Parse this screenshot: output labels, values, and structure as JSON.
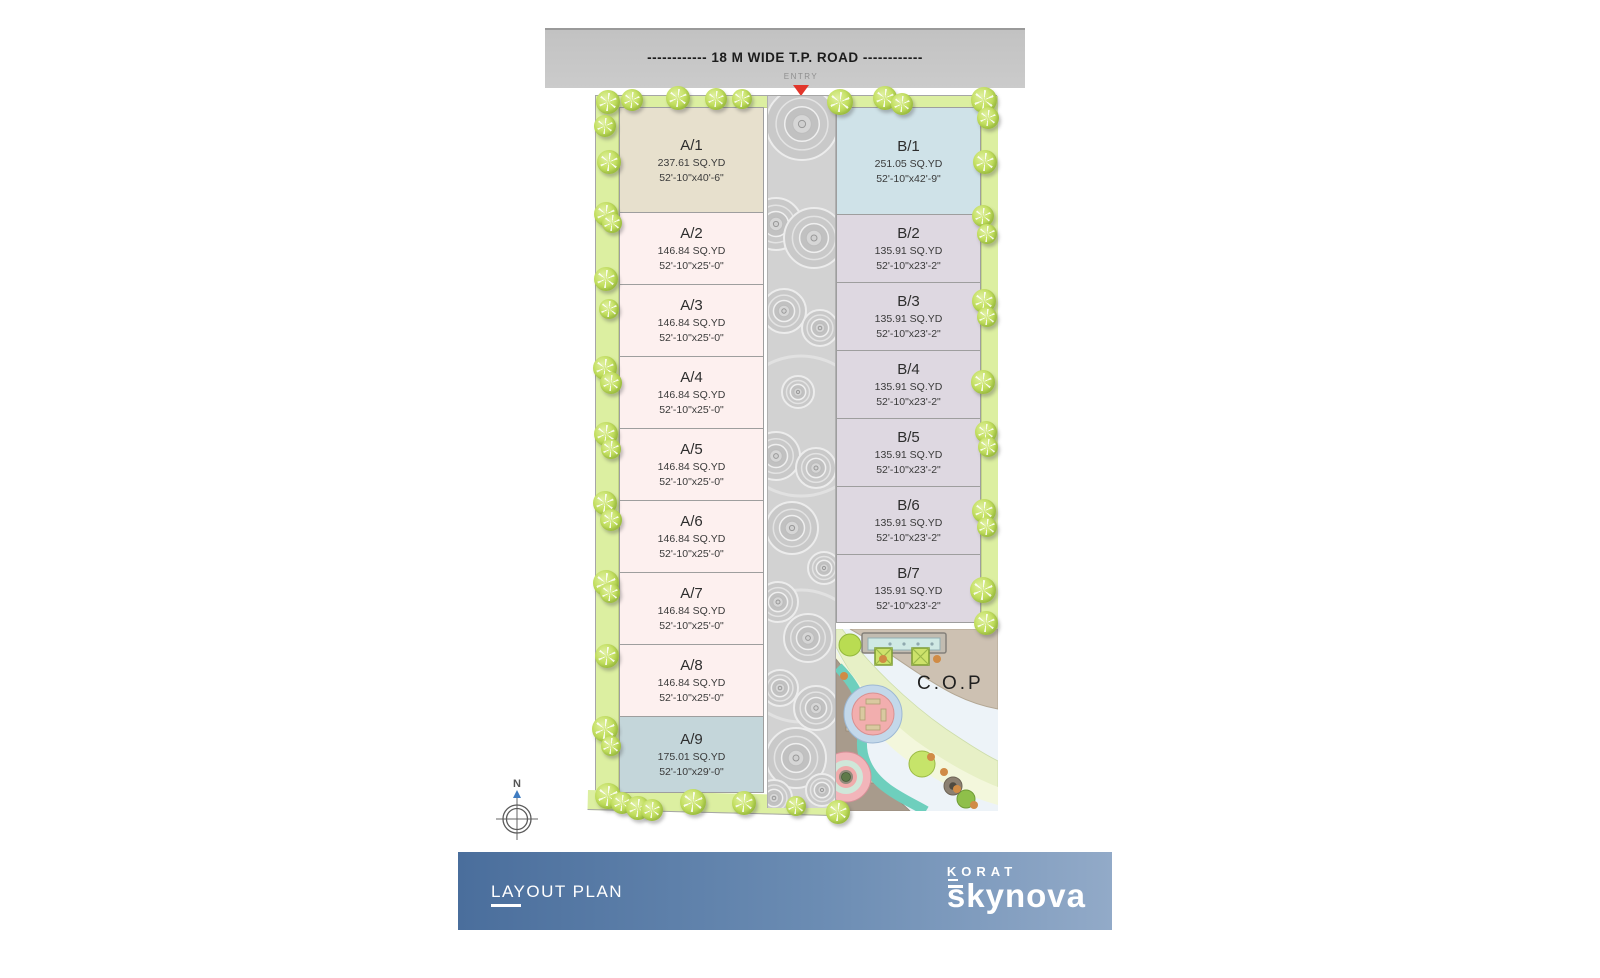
{
  "road_bar": {
    "label": "------------ 18 M WIDE T.P. ROAD ------------"
  },
  "entry": {
    "label": "ENTRY",
    "arrow_color": "#e2362b"
  },
  "plots_a": [
    {
      "label": "A/1",
      "area": "237.61 SQ.YD",
      "size": "52'-10\"x40'-6\"",
      "color": "#e7e0cd",
      "h": 106
    },
    {
      "label": "A/2",
      "area": "146.84 SQ.YD",
      "size": "52'-10\"x25'-0\"",
      "color": "#fdf0ef",
      "h": 73
    },
    {
      "label": "A/3",
      "area": "146.84 SQ.YD",
      "size": "52'-10\"x25'-0\"",
      "color": "#fdf0ef",
      "h": 73
    },
    {
      "label": "A/4",
      "area": "146.84 SQ.YD",
      "size": "52'-10\"x25'-0\"",
      "color": "#fdf0ef",
      "h": 73
    },
    {
      "label": "A/5",
      "area": "146.84 SQ.YD",
      "size": "52'-10\"x25'-0\"",
      "color": "#fdf0ef",
      "h": 73
    },
    {
      "label": "A/6",
      "area": "146.84 SQ.YD",
      "size": "52'-10\"x25'-0\"",
      "color": "#fdf0ef",
      "h": 73
    },
    {
      "label": "A/7",
      "area": "146.84 SQ.YD",
      "size": "52'-10\"x25'-0\"",
      "color": "#fdf0ef",
      "h": 73
    },
    {
      "label": "A/8",
      "area": "146.84 SQ.YD",
      "size": "52'-10\"x25'-0\"",
      "color": "#fdf0ef",
      "h": 73
    },
    {
      "label": "A/9",
      "area": "175.01 SQ.YD",
      "size": "52'-10\"x29'-0\"",
      "color": "#c4d6da",
      "h": 77
    }
  ],
  "plots_b": [
    {
      "label": "B/1",
      "area": "251.05 SQ.YD",
      "size": "52'-10\"x42'-9\"",
      "color": "#cfe2e8",
      "h": 108
    },
    {
      "label": "B/2",
      "area": "135.91 SQ.YD",
      "size": "52'-10\"x23'-2\"",
      "color": "#ded8e1",
      "h": 69
    },
    {
      "label": "B/3",
      "area": "135.91 SQ.YD",
      "size": "52'-10\"x23'-2\"",
      "color": "#ded8e1",
      "h": 69
    },
    {
      "label": "B/4",
      "area": "135.91 SQ.YD",
      "size": "52'-10\"x23'-2\"",
      "color": "#ded8e1",
      "h": 69
    },
    {
      "label": "B/5",
      "area": "135.91 SQ.YD",
      "size": "52'-10\"x23'-2\"",
      "color": "#ded8e1",
      "h": 69
    },
    {
      "label": "B/6",
      "area": "135.91 SQ.YD",
      "size": "52'-10\"x23'-2\"",
      "color": "#ded8e1",
      "h": 69
    },
    {
      "label": "B/7",
      "area": "135.91 SQ.YD",
      "size": "52'-10\"x23'-2\"",
      "color": "#ded8e1",
      "h": 69
    }
  ],
  "cop": {
    "label": "C.O.P"
  },
  "compass": {
    "label": "N"
  },
  "footer": {
    "title": "LAYOUT PLAN",
    "brand_top": "KORAT",
    "brand_bottom": "skynova"
  },
  "colors": {
    "green_strip": "#dcefa1",
    "tree": "#b7d94f",
    "road": "#d2d2d2",
    "banner_left": "#4a6e9c",
    "banner_right": "#92aac8",
    "entry_arrow": "#e2362b"
  }
}
